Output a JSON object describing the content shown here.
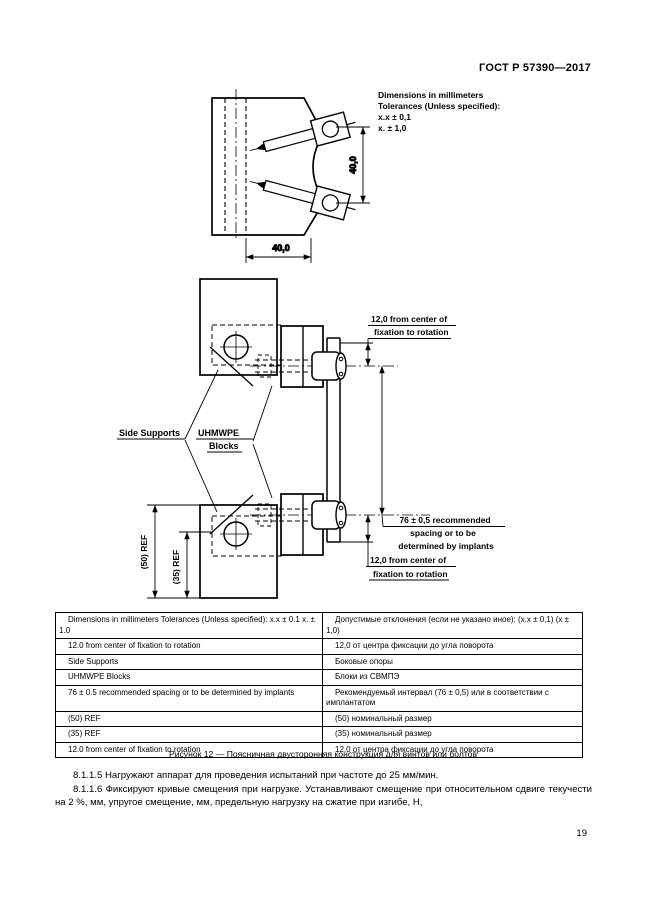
{
  "page": {
    "header": "ГОСТ Р 57390—2017",
    "page_number": "19"
  },
  "tolerance_note": {
    "line1": "Dimensions in millimeters",
    "line2": "Tolerances (Unless specified):",
    "line3": "x.x ± 0,1",
    "line4": "x. ± 1,0"
  },
  "drawing": {
    "top_view": {
      "dim_vertical": "40,0",
      "dim_horizontal": "40,0"
    },
    "front_view": {
      "label_side_supports": "Side Supports",
      "label_uhmwpe_line1": "UHMWPE",
      "label_uhmwpe_line2": "Blocks",
      "dim_top_offset_line1": "12,0 from center of",
      "dim_top_offset_line2": "fixation to rotation",
      "dim_spacing_line1": "76 ± 0,5 recommended",
      "dim_spacing_line2": "spacing or to be",
      "dim_spacing_line3": "determined by implants",
      "dim_bottom_offset_line1": "12,0 from center of",
      "dim_bottom_offset_line2": "fixation to rotation",
      "dim_ref_50": "(50) REF",
      "dim_ref_35": "(35) REF"
    }
  },
  "legend_table": {
    "rows": [
      {
        "en": "Dimensions in millimeters Tolerances (Unless specified): x.x ± 0.1 x. ± 1.0",
        "ru": "Допустимые отклонения (если не указано иное): (x.x ± 0,1) (x ± 1,0)"
      },
      {
        "en": "12.0 from center of fixation to rotation",
        "ru": "12,0 от центра фиксации до угла поворота"
      },
      {
        "en": "Side Supports",
        "ru": "Боковые опоры"
      },
      {
        "en": "UHMWPE Blocks",
        "ru": "Блоки из СВМПЭ"
      },
      {
        "en": "76 ± 0.5 recommended spacing or to be determined by implants",
        "ru": "Рекомендуемый интервал (76 ± 0,5) или в соответствии с имплантатом"
      },
      {
        "en": "(50) REF",
        "ru": "(50) номинальный размер"
      },
      {
        "en": "(35) REF",
        "ru": "(35) номинальный размер"
      },
      {
        "en": "12.0 from center of fixation to rotation",
        "ru": "12,0 от центра фиксации до угла поворота"
      }
    ]
  },
  "caption": "Рисунок 12 — Поясничная двусторонняя конструкция для винтов или болтов",
  "paragraphs": [
    "8.1.1.5 Нагружают аппарат для проведения испытаний при частоте до 25 мм/мин.",
    "8.1.1.6 Фиксируют кривые смещения при нагрузке. Устанавливают смещение при относительном сдвиге текучести на 2 %, мм, упругое смещение, мм, предельную нагрузку на сжатие при изгибе, Н,"
  ]
}
